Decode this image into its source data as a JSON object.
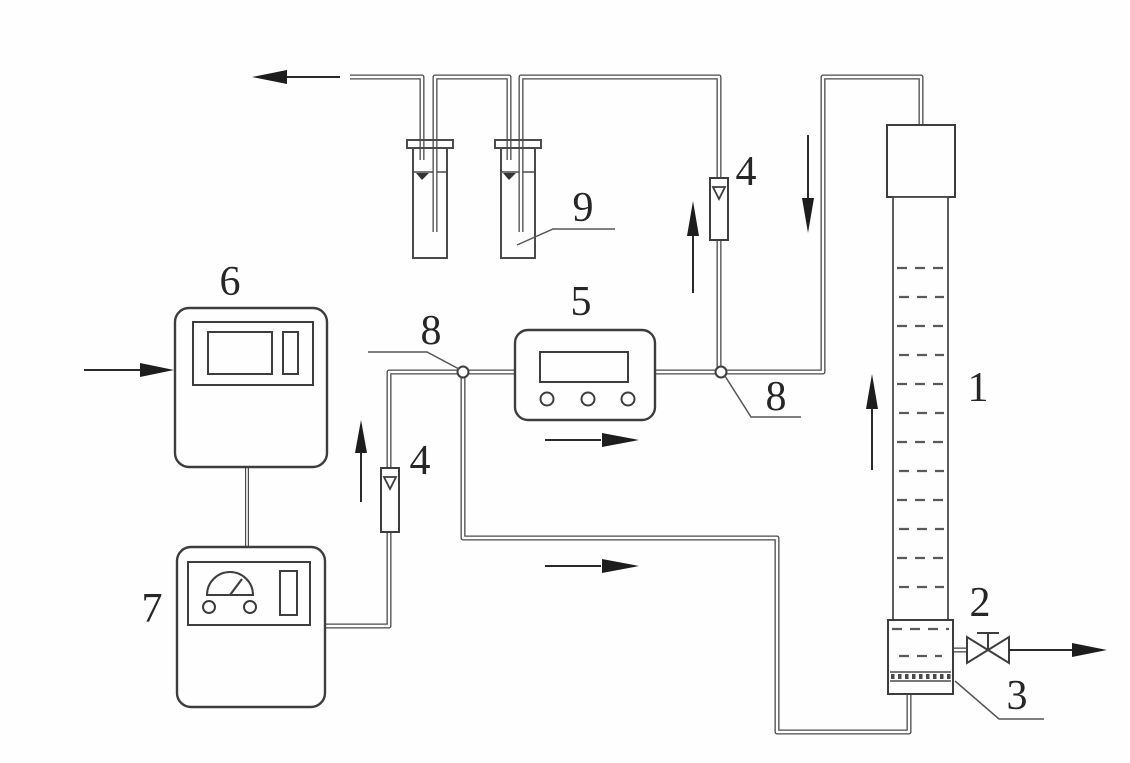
{
  "figure": {
    "background_color": "#fefefe",
    "line_color": "#4a4a4a",
    "arrow_color": "#1d1d1d",
    "text_color": "#262626"
  },
  "labels": {
    "column": "1",
    "valve": "2",
    "diffuser": "3",
    "flowmeter_left": "4",
    "flowmeter_right": "4",
    "detector": "5",
    "controller": "6",
    "power_meter": "7",
    "junction_left": "8",
    "junction_right": "8",
    "absorption_bottle": "9"
  },
  "icons": {
    "flow_arrows": [
      "exhaust-left-arrow",
      "inlet-right-arrow",
      "up-flow-arrow-left-flowmeter",
      "right-flow-arrow-detector",
      "right-flow-arrow-bottom-line",
      "up-flow-arrow-right-flowmeter",
      "down-flow-arrow-return-line",
      "up-flow-arrow-column",
      "outlet-right-arrow-valve"
    ]
  }
}
